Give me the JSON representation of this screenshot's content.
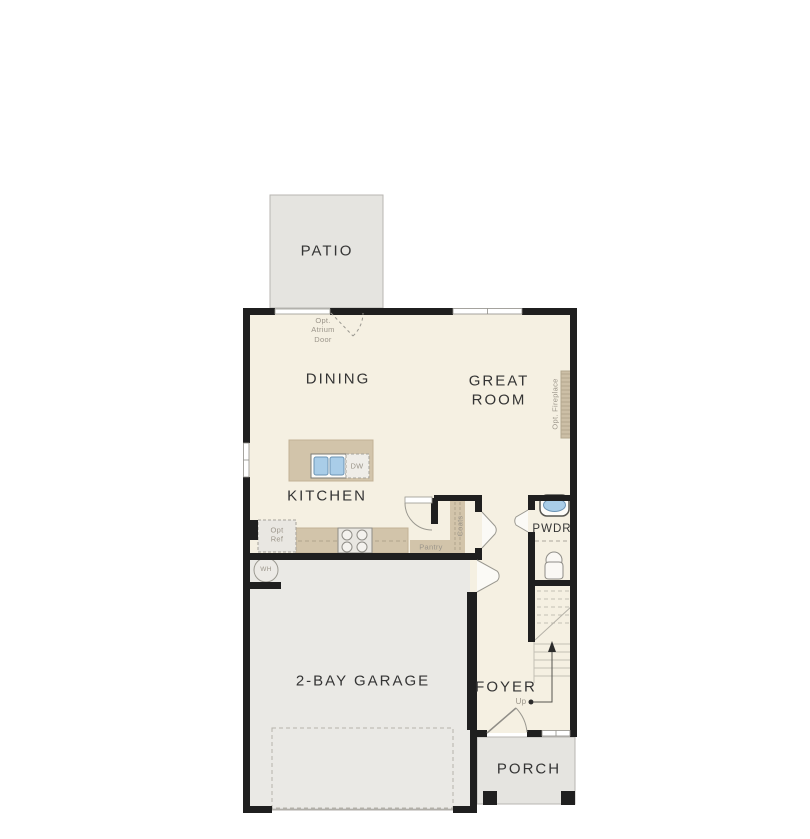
{
  "plan_title": "First floor plan",
  "rooms": {
    "patio": "PATIO",
    "dining": "DINING",
    "great_room": "GREAT ROOM",
    "kitchen": "KITCHEN",
    "garage": "2-BAY GARAGE",
    "foyer": "FOYER",
    "porch": "PORCH",
    "powder": "PWDR"
  },
  "annotations": {
    "opt_atrium_door": "Opt. Atrium Door",
    "opt_fireplace": "Opt. Fireplace",
    "opt_ref": "Opt Ref",
    "pantry": "Pantry",
    "coats": "Coats",
    "dishwasher": "DW",
    "water_heater": "WH",
    "stairs_up": "Up"
  },
  "colors": {
    "wall": "#1f1f1f",
    "interior_floor": "#f5f0e2",
    "garage_floor": "#eae9e5",
    "outdoor_surface": "#e5e4e0",
    "cabinetry_tan": "#d2c4aa",
    "fixture_blue": "#a9cde8",
    "annotation_gray": "#9b958a",
    "label_dark": "#343434"
  }
}
